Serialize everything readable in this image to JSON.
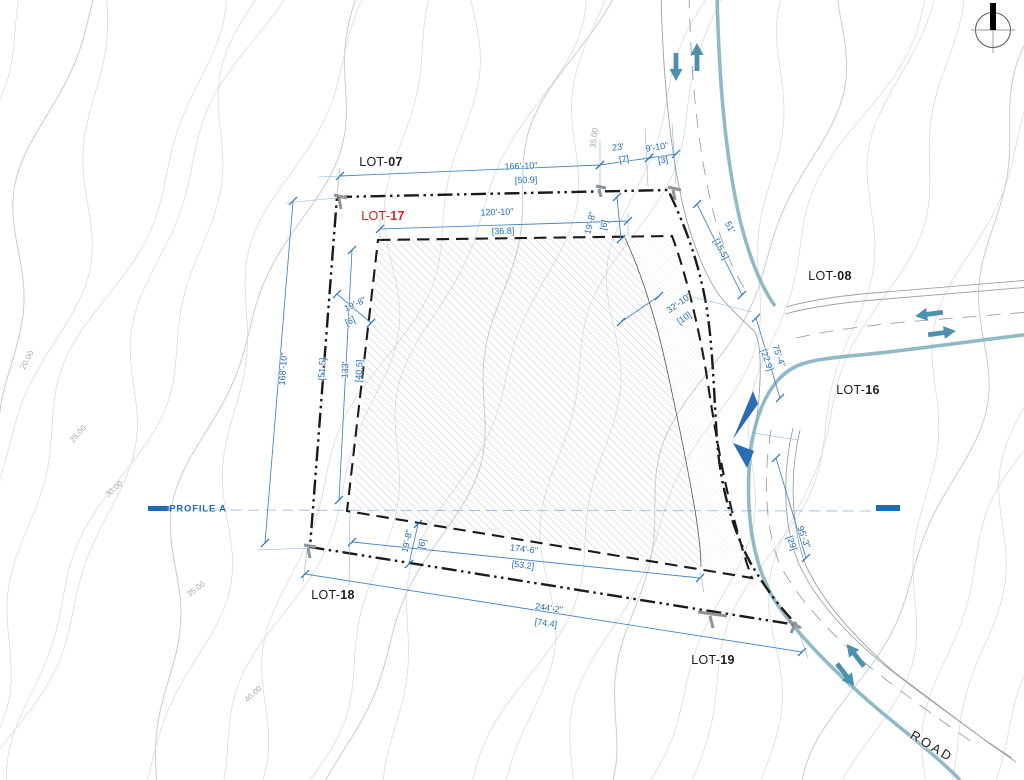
{
  "lots": [
    {
      "id": "lot-07",
      "prefix": "LOT-",
      "num": "07"
    },
    {
      "id": "lot-17",
      "prefix": "LOT-",
      "num": "17",
      "highlighted": true
    },
    {
      "id": "lot-08",
      "prefix": "LOT-",
      "num": "08"
    },
    {
      "id": "lot-16",
      "prefix": "LOT-",
      "num": "16"
    },
    {
      "id": "lot-18",
      "prefix": "LOT-",
      "num": "18"
    },
    {
      "id": "lot-19",
      "prefix": "LOT-",
      "num": "19"
    }
  ],
  "road_label": "ROAD",
  "profile_label": "PROFILE A",
  "dims": [
    {
      "id": "outer-top",
      "ft": "166'-10\"",
      "m": "[50.9]"
    },
    {
      "id": "top-seg-23",
      "ft": "23'",
      "m": "[7]"
    },
    {
      "id": "top-seg-9-10",
      "ft": "9'-10\"",
      "m": "[3]"
    },
    {
      "id": "inner-top",
      "ft": "120'-10\"",
      "m": "[36.8]"
    },
    {
      "id": "setback-top",
      "ft": "19'-8\"",
      "m": "[6]"
    },
    {
      "id": "setback-left",
      "ft": "19'-8\"",
      "m": "[6]"
    },
    {
      "id": "setback-bottom",
      "ft": "19'-8\"",
      "m": "[6]"
    },
    {
      "id": "outer-left",
      "ft": "168'-10\"",
      "m": "[51.5]"
    },
    {
      "id": "inner-left",
      "ft": "133'",
      "m": "[40.5]"
    },
    {
      "id": "band-width",
      "ft": "32'-10\"",
      "m": "[10]"
    },
    {
      "id": "road-51",
      "ft": "51'",
      "m": "[15.5]"
    },
    {
      "id": "road-75",
      "ft": "75'-4\"",
      "m": "[22.9]"
    },
    {
      "id": "road-95",
      "ft": "95'-3\"",
      "m": "[29]"
    },
    {
      "id": "inner-bottom",
      "ft": "174'-6\"",
      "m": "[53.2]"
    },
    {
      "id": "outer-bottom",
      "ft": "244'-2\"",
      "m": "[74.4]"
    }
  ],
  "contour_labels": [
    {
      "text": "20.00"
    },
    {
      "text": "25.00"
    },
    {
      "text": "30.00"
    },
    {
      "text": "35.00"
    },
    {
      "text": "40.00"
    },
    {
      "text": "35.00"
    }
  ],
  "colors": {
    "dimension_blue": "#1d6cb5",
    "lot17_red": "#d81e1e",
    "road_teal": "#7fadbc",
    "arrow_teal": "#4c90ad",
    "boundary_black": "#1a1a1a"
  }
}
